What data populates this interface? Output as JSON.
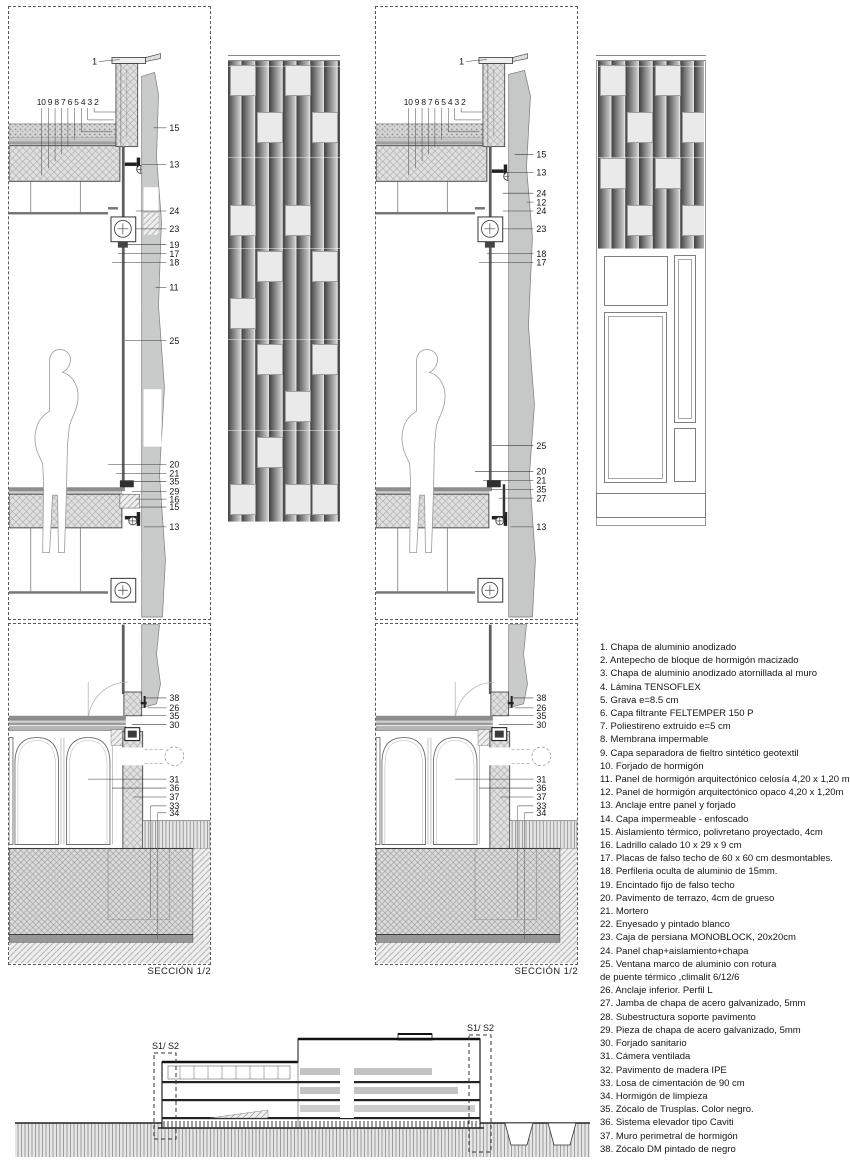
{
  "sheet": {
    "background": "#ffffff",
    "line_color": "#2b2b2b"
  },
  "details": {
    "d1": {
      "top_callout": "1",
      "layers_row": "10 9 8 7 6 5 4 3 2",
      "right": [
        {
          "t": "15",
          "y": 120,
          "lx": 146
        },
        {
          "t": "13",
          "y": 157,
          "lx": 134
        },
        {
          "t": "24",
          "y": 204,
          "lx": 128
        },
        {
          "t": "23",
          "y": 222,
          "lx": 128
        },
        {
          "t": "19",
          "y": 238,
          "lx": 116
        },
        {
          "t": "17",
          "y": 247,
          "lx": 110
        },
        {
          "t": "18",
          "y": 256,
          "lx": 104
        },
        {
          "t": "11",
          "y": 281,
          "lx": 148
        },
        {
          "t": "25",
          "y": 335,
          "lx": 117
        },
        {
          "t": "20",
          "y": 460,
          "lx": 100
        },
        {
          "t": "21",
          "y": 469,
          "lx": 108
        },
        {
          "t": "35",
          "y": 477,
          "lx": 116
        },
        {
          "t": "29",
          "y": 487,
          "lx": 124
        },
        {
          "t": "16",
          "y": 495,
          "lx": 128
        },
        {
          "t": "15",
          "y": 503,
          "lx": 132
        },
        {
          "t": "13",
          "y": 523,
          "lx": 136
        }
      ]
    },
    "d2": {
      "top_callout": "1",
      "layers_row": "10 9 8 7 6 5 4 3 2",
      "right": [
        {
          "t": "15",
          "y": 147,
          "lx": 140
        },
        {
          "t": "13",
          "y": 165,
          "lx": 134
        },
        {
          "t": "24",
          "y": 186,
          "lx": 128
        },
        {
          "t": "12",
          "y": 195,
          "lx": 152
        },
        {
          "t": "24",
          "y": 204,
          "lx": 128
        },
        {
          "t": "23",
          "y": 222,
          "lx": 128
        },
        {
          "t": "18",
          "y": 247,
          "lx": 112
        },
        {
          "t": "17",
          "y": 256,
          "lx": 104
        },
        {
          "t": "25",
          "y": 441,
          "lx": 117
        },
        {
          "t": "20",
          "y": 467,
          "lx": 100
        },
        {
          "t": "21",
          "y": 476,
          "lx": 108
        },
        {
          "t": "35",
          "y": 485,
          "lx": 116
        },
        {
          "t": "27",
          "y": 494,
          "lx": 124
        },
        {
          "t": "13",
          "y": 523,
          "lx": 136
        }
      ]
    },
    "d3": {
      "section_label": "SECCIÓN 1/2",
      "callouts": [
        {
          "t": "38",
          "y": 74,
          "lx": 136
        },
        {
          "t": "26",
          "y": 84,
          "lx": 140
        },
        {
          "t": "35",
          "y": 92,
          "lx": 134
        },
        {
          "t": "30",
          "y": 101,
          "lx": 124
        },
        {
          "t": "31",
          "y": 156,
          "lx": 80
        },
        {
          "t": "36",
          "y": 165,
          "lx": 104
        },
        {
          "t": "37",
          "y": 174,
          "lx": 126
        },
        {
          "t": "33",
          "y": 183,
          "lx": 143
        },
        {
          "t": "34",
          "y": 190,
          "lx": 150
        }
      ]
    },
    "d4": {
      "section_label": "SECCIÓN 1/2",
      "callouts": [
        {
          "t": "38",
          "y": 74,
          "lx": 136
        },
        {
          "t": "26",
          "y": 84,
          "lx": 140
        },
        {
          "t": "35",
          "y": 92,
          "lx": 134
        },
        {
          "t": "30",
          "y": 101,
          "lx": 124
        },
        {
          "t": "31",
          "y": 156,
          "lx": 80
        },
        {
          "t": "36",
          "y": 165,
          "lx": 104
        },
        {
          "t": "37",
          "y": 174,
          "lx": 126
        },
        {
          "t": "33",
          "y": 183,
          "lx": 143
        },
        {
          "t": "34",
          "y": 190,
          "lx": 150
        }
      ]
    }
  },
  "elevations": {
    "left": {
      "squares": [
        [
          0,
          0
        ],
        [
          2,
          0
        ],
        [
          1,
          1
        ],
        [
          3,
          1
        ],
        [
          0,
          3
        ],
        [
          2,
          3
        ],
        [
          1,
          4
        ],
        [
          3,
          4
        ],
        [
          0,
          5
        ],
        [
          1,
          6
        ],
        [
          3,
          6
        ],
        [
          2,
          7
        ],
        [
          1,
          8
        ],
        [
          0,
          9
        ],
        [
          2,
          9
        ],
        [
          3,
          9
        ]
      ]
    },
    "right": {
      "squares": [
        [
          0,
          0
        ],
        [
          2,
          0
        ],
        [
          1,
          1
        ],
        [
          3,
          1
        ],
        [
          0,
          2
        ],
        [
          2,
          2
        ],
        [
          1,
          3
        ],
        [
          3,
          3
        ]
      ]
    }
  },
  "overview": {
    "marker_left": "S1/ S2",
    "marker_right": "S1/ S2"
  },
  "legend": {
    "items": [
      "1. Chapa de aluminio anodizado",
      "2. Antepecho de bloque de hormigón macizado",
      "3. Chapa de aluminio anodizado atornillada al muro",
      "4. Lámina TENSOFLEX",
      "5. Grava e=8.5 cm",
      "6. Capa filtrante FELTEMPER 150 P",
      "7. Poliestireno extruido e=5 cm",
      "8. Membrana impermable",
      "9. Capa separadora de fieltro sintético geotextil",
      "10. Forjado de hormigón",
      "11. Panel de hormigón arquitectónico celosía 4,20 x 1,20 m",
      "12. Panel de hormigón arquitectónico opaco  4,20 x 1,20m",
      "13. Anclaje entre panel y forjado",
      "14. Capa impermeable - enfoscado",
      "15. Aislamiento térmico, polivretano proyectado, 4cm",
      "16. Ladrillo calado 10 x 29 x 9 cm",
      "17. Placas de falso techo de 60 x 60 cm desmontables.",
      "18. Perfileria oculta de aluminio de 15mm.",
      "19. Encintado fijo de falso techo",
      "20. Pavimento de terrazo, 4cm de grueso",
      "21. Mortero",
      "22. Enyesado y pintado blanco",
      "23. Caja de persiana MONOBLOCK,  20x20cm",
      "24. Panel chap+aislamiento+chapa",
      "25. Ventana marco de aluminio con rotura\n de puente térmico ,climalit 6/12/6",
      "26. Anclaje inferior. Perfil L",
      "27. Jamba de chapa de acero galvanizado, 5mm",
      "28. Subestructura soporte pavimento",
      "29. Pieza de chapa de acero galvanizado, 5mm",
      "30. Forjado sanitario",
      "31. Cámera ventilada",
      "32. Pavimento de madera IPE",
      "33. Losa de cimentación de 90 cm",
      "34. Hormigón de limpieza",
      "35. Zócalo de Trusplas. Color negro.",
      "36. Sistema elevador tipo Caviti",
      "37. Muro perimetral de hormigón",
      "38. Zócalo DM pintado de negro"
    ]
  }
}
